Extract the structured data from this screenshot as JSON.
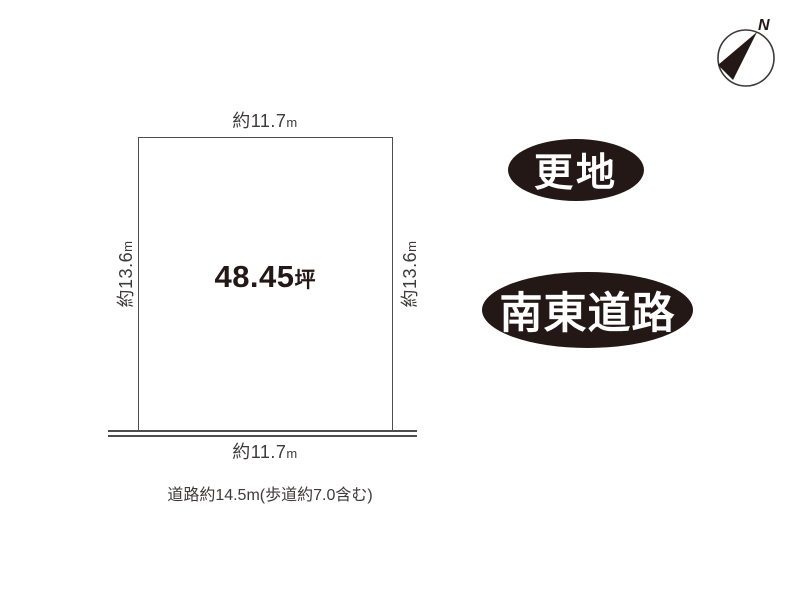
{
  "plot": {
    "area": {
      "value": "48.45",
      "unit": "坪"
    },
    "dims": {
      "top": {
        "value": "約11.7",
        "unit": "m"
      },
      "bottom": {
        "value": "約11.7",
        "unit": "m"
      },
      "left": {
        "value": "約13.6",
        "unit": "m"
      },
      "right": {
        "value": "約13.6",
        "unit": "m"
      }
    }
  },
  "road_note": "道路約14.5m(歩道約7.0含む)",
  "badges": {
    "land_status": "更地",
    "road_direction": "南東道路"
  },
  "compass": {
    "north_label": "N"
  },
  "colors": {
    "ink": "#231815",
    "line": "#4d4d4d",
    "badge_bg": "#231815",
    "badge_text": "#ffffff"
  }
}
